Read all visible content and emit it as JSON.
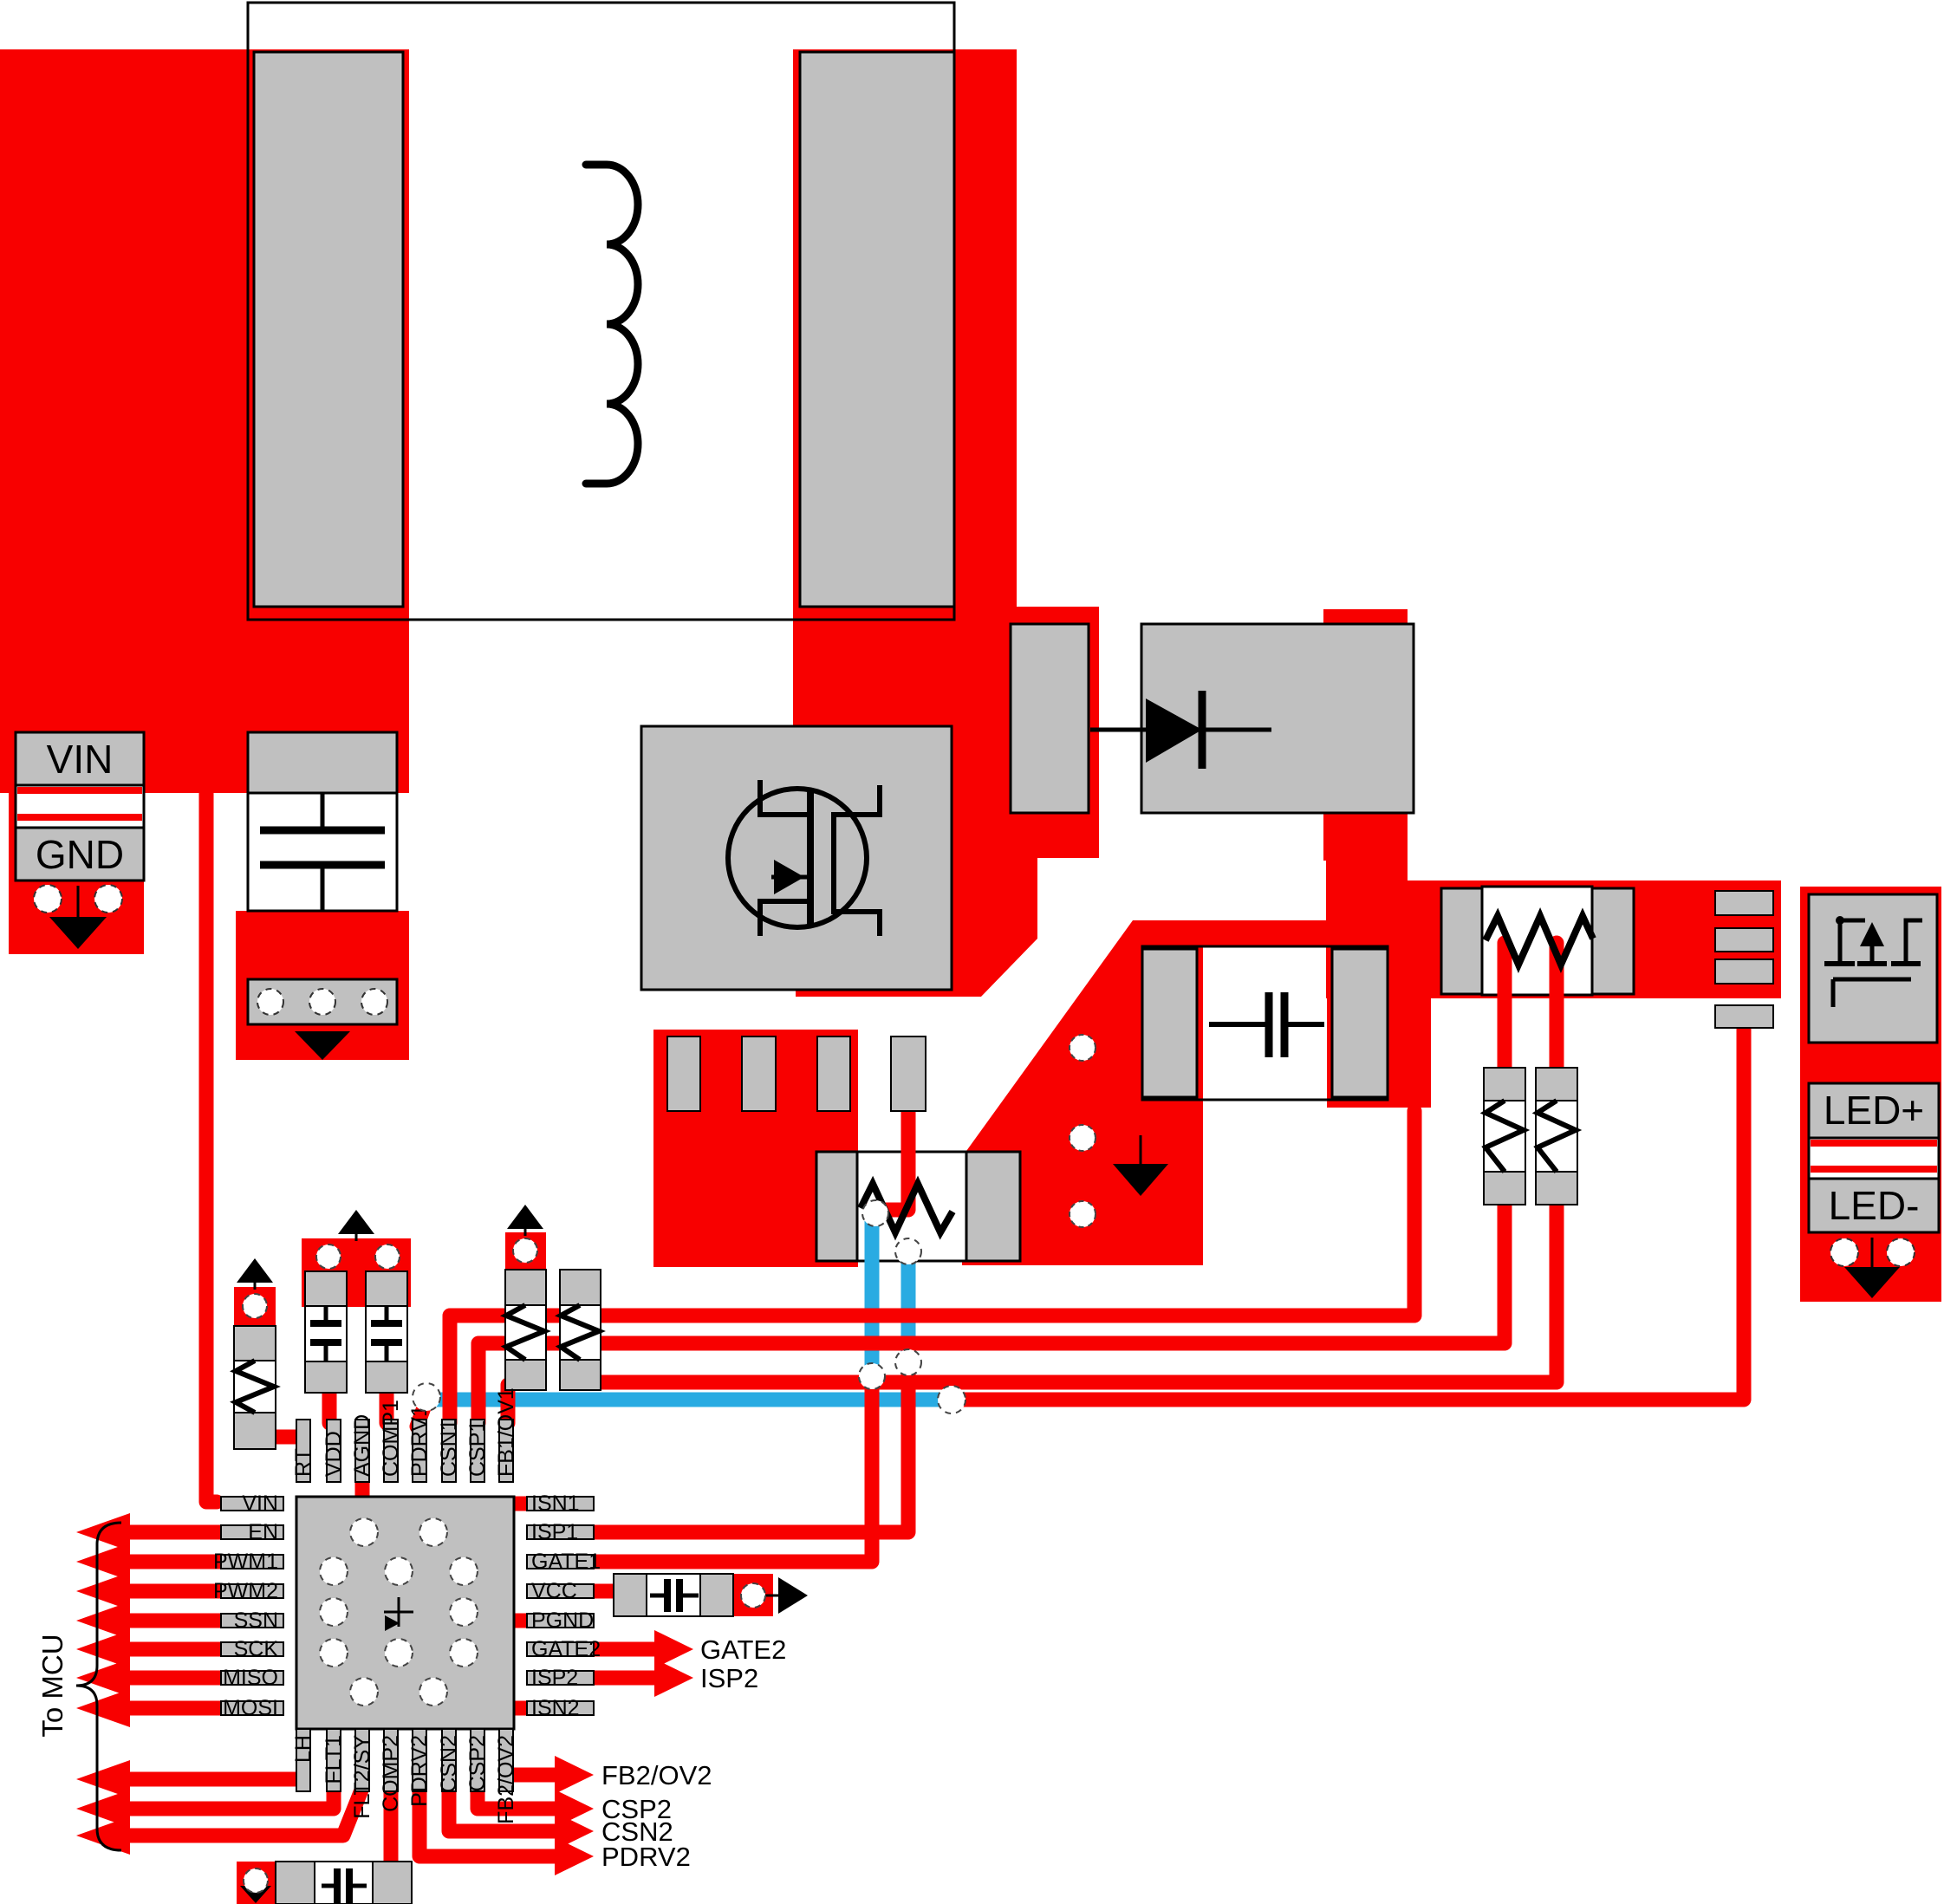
{
  "connectors": {
    "vin": "VIN",
    "gnd": "GND",
    "led_plus": "LED+",
    "led_minus": "LED-"
  },
  "ic": {
    "top_pins": [
      "RT",
      "VDD",
      "AGND",
      "COMP1",
      "PDRV1",
      "CSN1",
      "CSP1",
      "FB1/OV1"
    ],
    "left_pins": [
      "VIN",
      "EN",
      "PWM1",
      "PWM2",
      "SSN",
      "SCK",
      "MISO",
      "MOSI"
    ],
    "right_pins": [
      "ISN1",
      "ISP1",
      "GATE1",
      "VCC",
      "PGND",
      "GATE2",
      "ISP2",
      "ISN2"
    ],
    "bottom_pins": [
      "LH",
      "FLT1",
      "FLT2/SY",
      "COMP2",
      "PDRV2",
      "CSN2",
      "CSP2",
      "FB2/OV2"
    ]
  },
  "signal_labels": {
    "gate2": "GATE2",
    "isp2": "ISP2",
    "fb2_ov2": "FB2/OV2",
    "csp2": "CSP2",
    "csn2": "CSN2",
    "pdrv2": "PDRV2"
  },
  "annotations": {
    "to_mcu": "To MCU"
  },
  "colors": {
    "top_copper": "#f80000",
    "bottom_copper": "#29abe2",
    "pad_gray": "#c0c0c0",
    "outline": "#000000"
  }
}
